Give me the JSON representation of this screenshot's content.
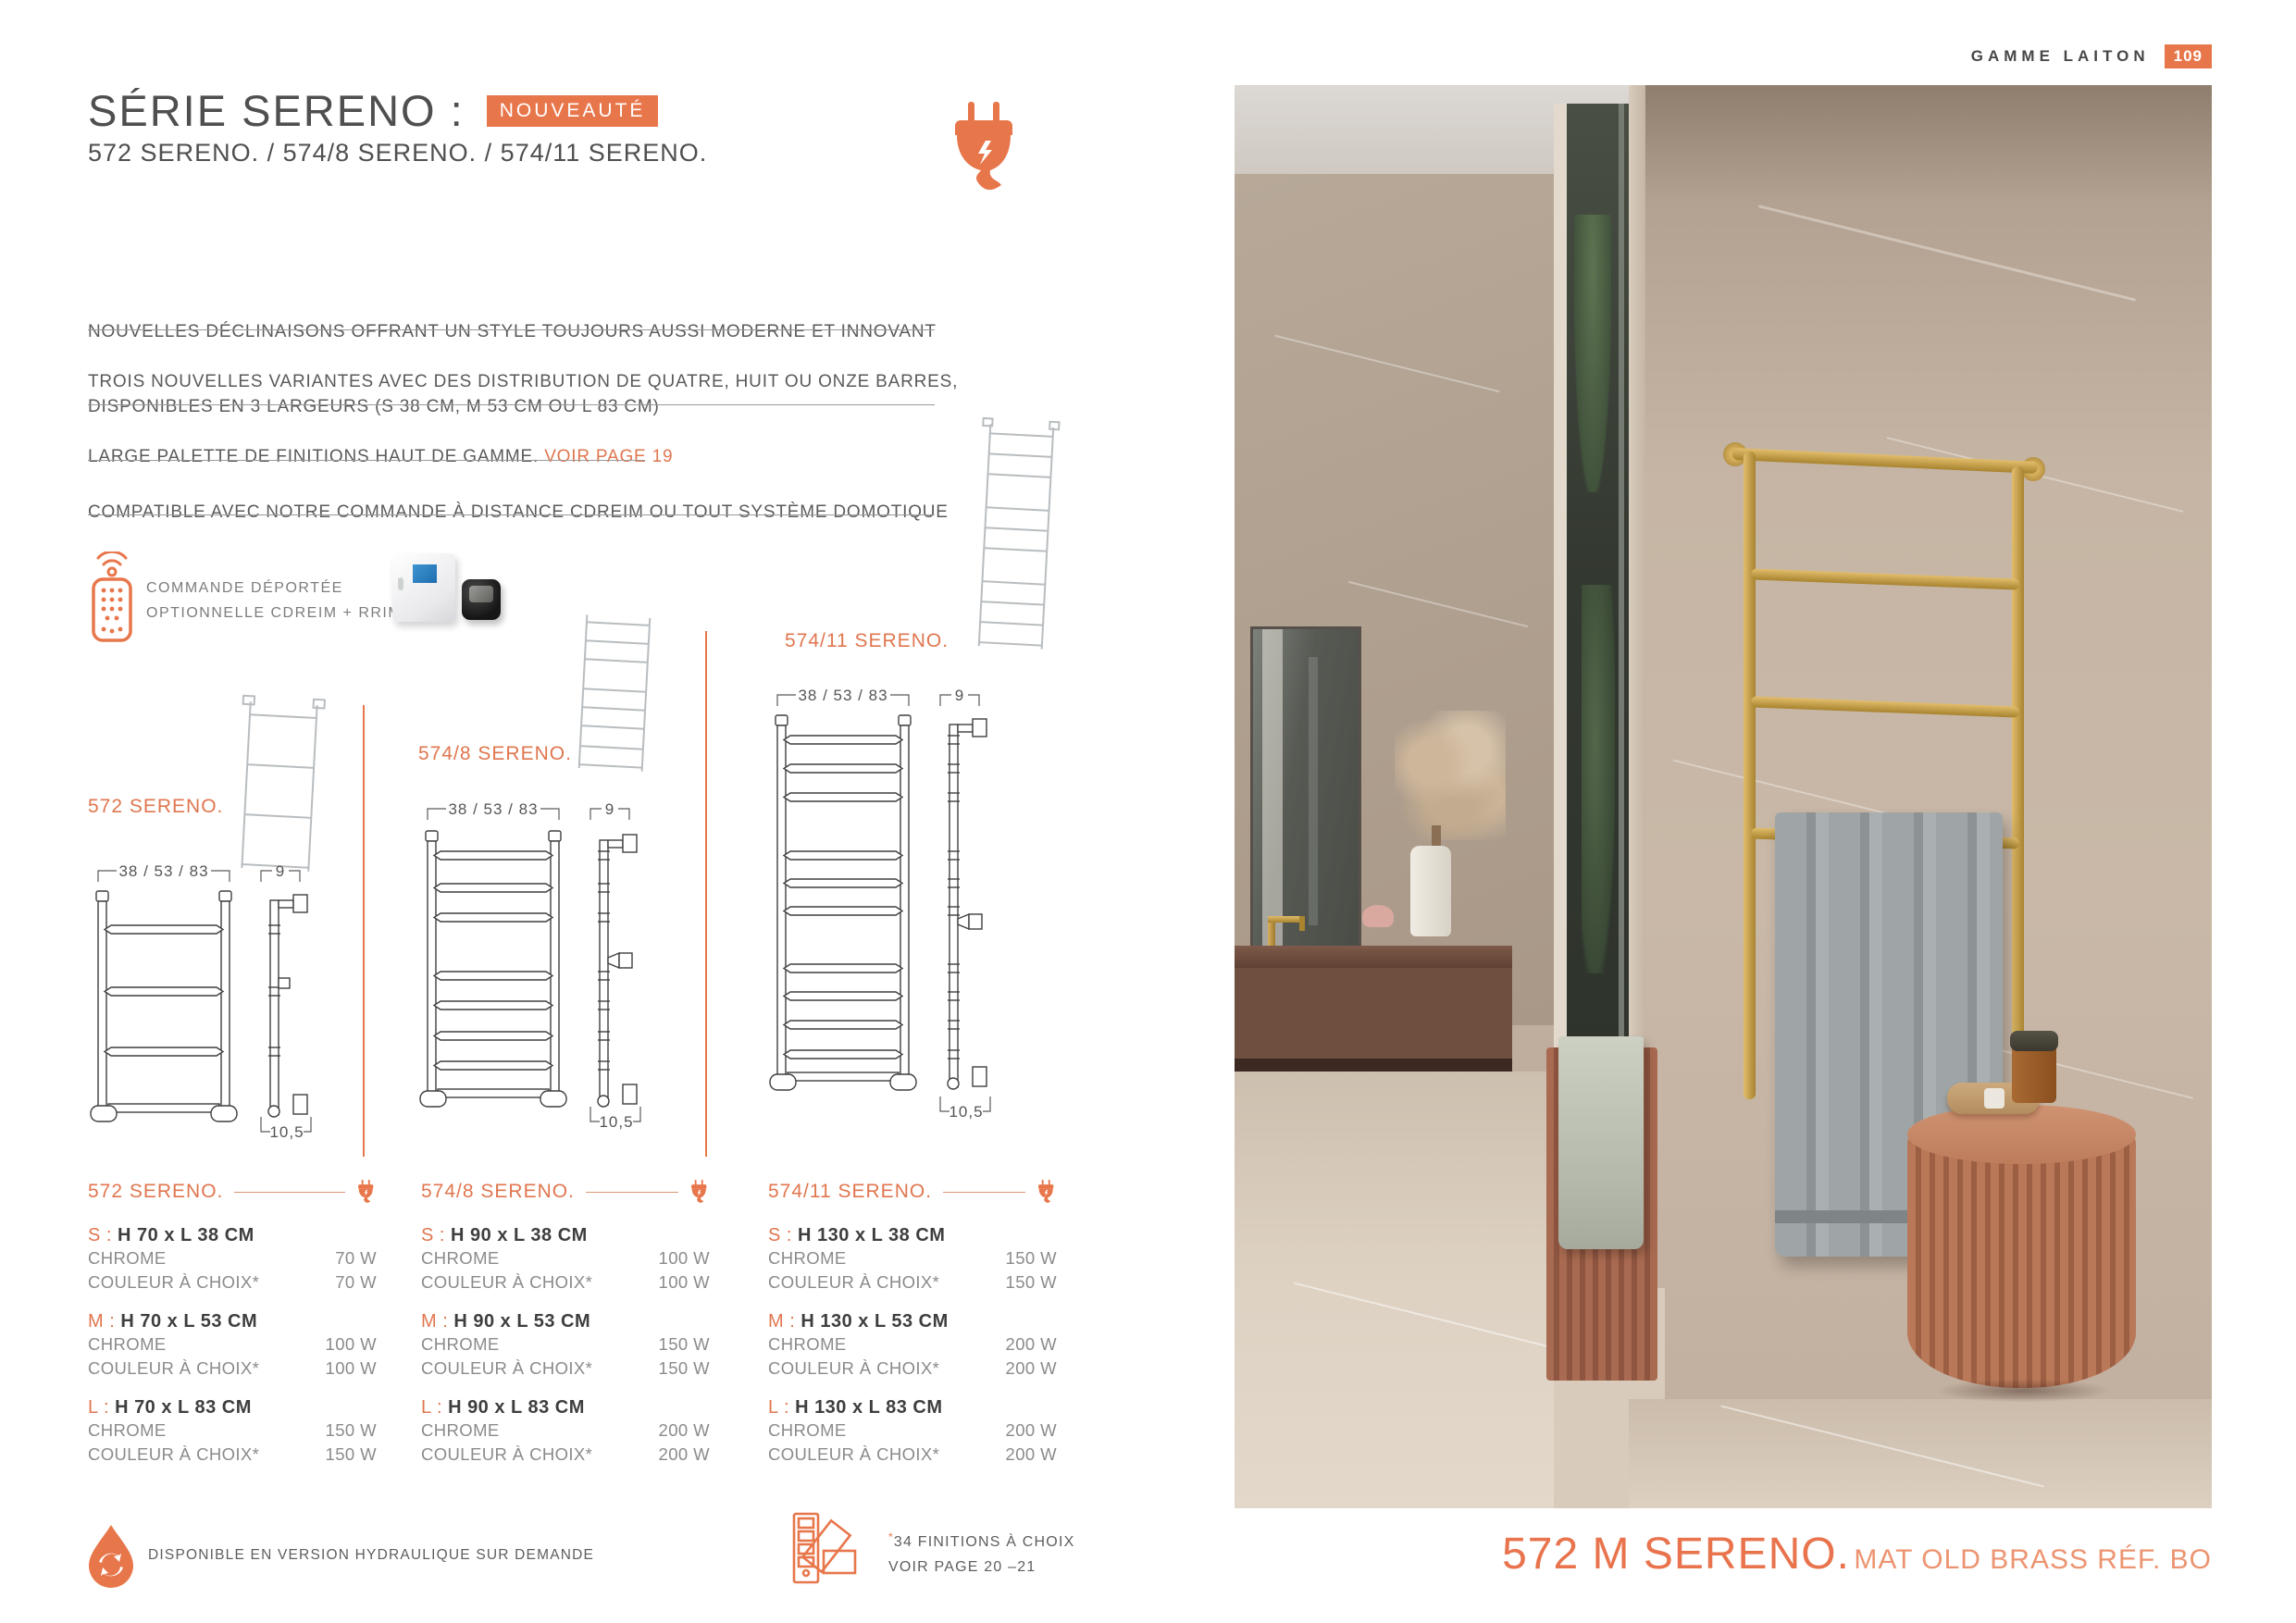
{
  "header": {
    "label": "GAMME LAITON",
    "page_number": "109"
  },
  "hero": {
    "title": "SÉRIE SERENO :",
    "badge": "NOUVEAUTÉ",
    "subtitle": "572 SERENO. / 574/8 SERENO. / 574/11 SERENO."
  },
  "features": [
    {
      "text": "NOUVELLES DÉCLINAISONS OFFRANT UN STYLE TOUJOURS AUSSI MODERNE ET INNOVANT",
      "link": ""
    },
    {
      "text": "TROIS NOUVELLES VARIANTES AVEC DES DISTRIBUTION DE QUATRE, HUIT OU ONZE BARRES,\nDISPONIBLES EN 3 LARGEURS (S 38 CM, M 53 CM OU L 83 CM)",
      "link": ""
    },
    {
      "text": "LARGE PALETTE DE FINITIONS HAUT DE GAMME. ",
      "link": "VOIR PAGE 19"
    },
    {
      "text": "COMPATIBLE AVEC NOTRE COMMANDE À DISTANCE CDREIM OU TOUT SYSTÈME DOMOTIQUE",
      "link": ""
    }
  ],
  "remote": {
    "line1": "COMMANDE DÉPORTÉE",
    "line2": "OPTIONNELLE CDREIM + RRIM"
  },
  "drawings": [
    {
      "label": "572 SERENO.",
      "width_dim": "38 / 53 / 83",
      "depth_top": "9",
      "depth_bottom": "10,5"
    },
    {
      "label": "574/8 SERENO.",
      "width_dim": "38 / 53 / 83",
      "depth_top": "9",
      "depth_bottom": "10,5"
    },
    {
      "label": "574/11 SERENO.",
      "width_dim": "38 / 53 / 83",
      "depth_top": "9",
      "depth_bottom": "10,5"
    }
  ],
  "products": [
    {
      "name": "572 SERENO.",
      "sizes": [
        {
          "label": "S",
          "dims": "H 70 x L 38 CM",
          "rows": [
            {
              "finish": "CHROME",
              "power": "70 W"
            },
            {
              "finish": "COULEUR À CHOIX*",
              "power": "70 W"
            }
          ]
        },
        {
          "label": "M",
          "dims": "H 70 x L 53 CM",
          "rows": [
            {
              "finish": "CHROME",
              "power": "100 W"
            },
            {
              "finish": "COULEUR À CHOIX*",
              "power": "100 W"
            }
          ]
        },
        {
          "label": "L",
          "dims": "H 70 x L 83 CM",
          "rows": [
            {
              "finish": "CHROME",
              "power": "150 W"
            },
            {
              "finish": "COULEUR À CHOIX*",
              "power": "150 W"
            }
          ]
        }
      ]
    },
    {
      "name": "574/8 SERENO.",
      "sizes": [
        {
          "label": "S",
          "dims": "H 90 x L 38 CM",
          "rows": [
            {
              "finish": "CHROME",
              "power": "100 W"
            },
            {
              "finish": "COULEUR À CHOIX*",
              "power": "100 W"
            }
          ]
        },
        {
          "label": "M",
          "dims": "H 90 x L 53 CM",
          "rows": [
            {
              "finish": "CHROME",
              "power": "150 W"
            },
            {
              "finish": "COULEUR À CHOIX*",
              "power": "150 W"
            }
          ]
        },
        {
          "label": "L",
          "dims": "H 90 x L 83 CM",
          "rows": [
            {
              "finish": "CHROME",
              "power": "200 W"
            },
            {
              "finish": "COULEUR À CHOIX*",
              "power": "200 W"
            }
          ]
        }
      ]
    },
    {
      "name": "574/11 SERENO.",
      "sizes": [
        {
          "label": "S",
          "dims": "H 130 x L 38 CM",
          "rows": [
            {
              "finish": "CHROME",
              "power": "150 W"
            },
            {
              "finish": "COULEUR À CHOIX*",
              "power": "150 W"
            }
          ]
        },
        {
          "label": "M",
          "dims": "H 130 x L 53 CM",
          "rows": [
            {
              "finish": "CHROME",
              "power": "200 W"
            },
            {
              "finish": "COULEUR À CHOIX*",
              "power": "200 W"
            }
          ]
        },
        {
          "label": "L",
          "dims": "H 130 x L 83 CM",
          "rows": [
            {
              "finish": "CHROME",
              "power": "200 W"
            },
            {
              "finish": "COULEUR À CHOIX*",
              "power": "200 W"
            }
          ]
        }
      ]
    }
  ],
  "footer": {
    "hydraulic": "DISPONIBLE EN VERSION HYDRAULIQUE SUR DEMANDE",
    "finitions_star": "*",
    "finitions_line1": "34 FINITIONS À CHOIX",
    "finitions_line2": "VOIR PAGE 20 –21"
  },
  "caption": {
    "main": "572 M SERENO.",
    "sub": "MAT OLD BRASS RÉF. BO"
  },
  "colors": {
    "accent": "#e8764b",
    "accent_light": "#ec9471",
    "text_dark": "#4a4a4a",
    "text_gray": "#8b8b8b",
    "brass": "#c19a4b",
    "terracotta": "#b97857"
  }
}
